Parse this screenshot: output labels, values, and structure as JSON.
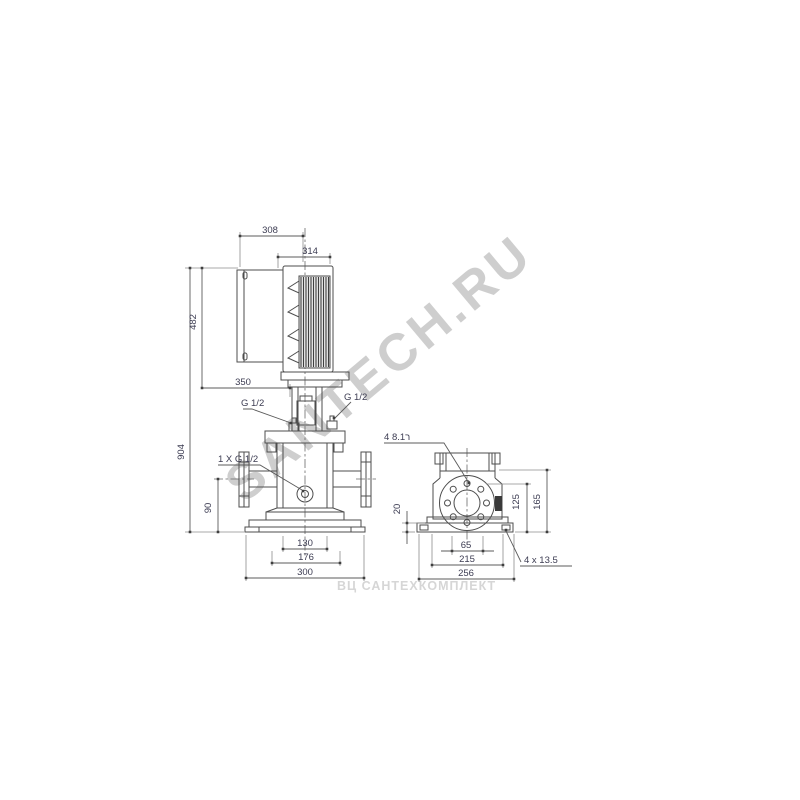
{
  "watermarks": {
    "diagonal": "SANTECH.RU",
    "bottom": "ВЦ САНТЕХКОМПЛЕКТ"
  },
  "front_view": {
    "dims": {
      "d308": "308",
      "d314": "314",
      "d482": "482",
      "d904": "904",
      "d350": "350",
      "g_half_left": "G 1/2",
      "g_half_right": "G 1/2",
      "drain_port": "1 X G 1/2",
      "d90": "90",
      "d130": "130",
      "d176": "176",
      "d300": "300"
    }
  },
  "side_view": {
    "dims": {
      "flange_holes": "4 ר8.1",
      "d20": "20",
      "d125": "125",
      "d165": "165",
      "d65": "65",
      "d215": "215",
      "d256": "256",
      "base_holes": "4 x 13.5"
    }
  },
  "colors": {
    "background": "#ffffff",
    "line": "#4d4d4d",
    "extension_line": "#8c8c8c",
    "dimension_text": "#3c3c52",
    "flange_edge_fill": "#3a3a3a",
    "watermark_diagonal": "#9a9a9a",
    "watermark_bottom": "#d6d6d6"
  }
}
